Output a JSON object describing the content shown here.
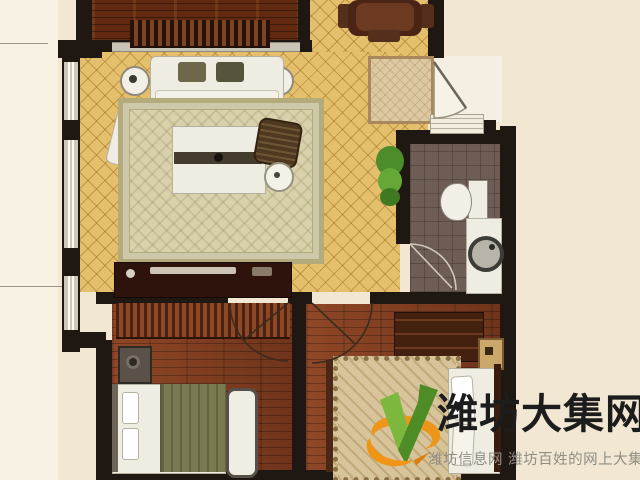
{
  "watermark": {
    "title": "潍坊大集网",
    "subtitle": "潍坊信息网 潍坊百姓的网上大集",
    "logo_icon": "green-check-v-with-orange-swoosh"
  },
  "colors": {
    "bg": "#f1e7d2",
    "bg_left": "#f7f2e4",
    "wall": "#1f1711",
    "arc": "#3a2c1e",
    "tile": "#e5c06c",
    "tile_line": "#9b6c23",
    "wood_balcony": "#61290f",
    "wood_bedroom": "#7c3a1f",
    "bath_floor": "#6d5d54",
    "rug": "#d8d1ab",
    "rug_border": "#b3ab7c",
    "fabric": "#efece2",
    "olive": "#6d684a",
    "logo_green": "#7cb83d",
    "logo_green_dark": "#4e8c26",
    "logo_orange": "#ef9413",
    "title": "#1c1c1c",
    "subtitle": "#8f8d84"
  },
  "plan": {
    "type": "residential-floor-plan",
    "rooms": [
      {
        "name": "balcony",
        "floor": "dark-wood-planks"
      },
      {
        "name": "living-dining-room",
        "floor": "yellow-diamond-tile"
      },
      {
        "name": "entry",
        "floor": "tile-with-door-swing"
      },
      {
        "name": "bathroom",
        "floor": "dark-gray-tile"
      },
      {
        "name": "bedroom-left",
        "floor": "red-brown-wood"
      },
      {
        "name": "bedroom-right",
        "floor": "red-brown-wood"
      }
    ],
    "furniture": [
      "sofa",
      "side-lamp-tables",
      "armchair",
      "wicker-chair",
      "round-table",
      "area-rug",
      "coffee-table",
      "tv-console",
      "dining-table",
      "entry-rug",
      "potted-plant",
      "toilet",
      "sink-vanity",
      "radiator-dresser",
      "speaker-nightstand",
      "bed-left",
      "bench",
      "dresser",
      "nightstand",
      "bed-right"
    ]
  }
}
